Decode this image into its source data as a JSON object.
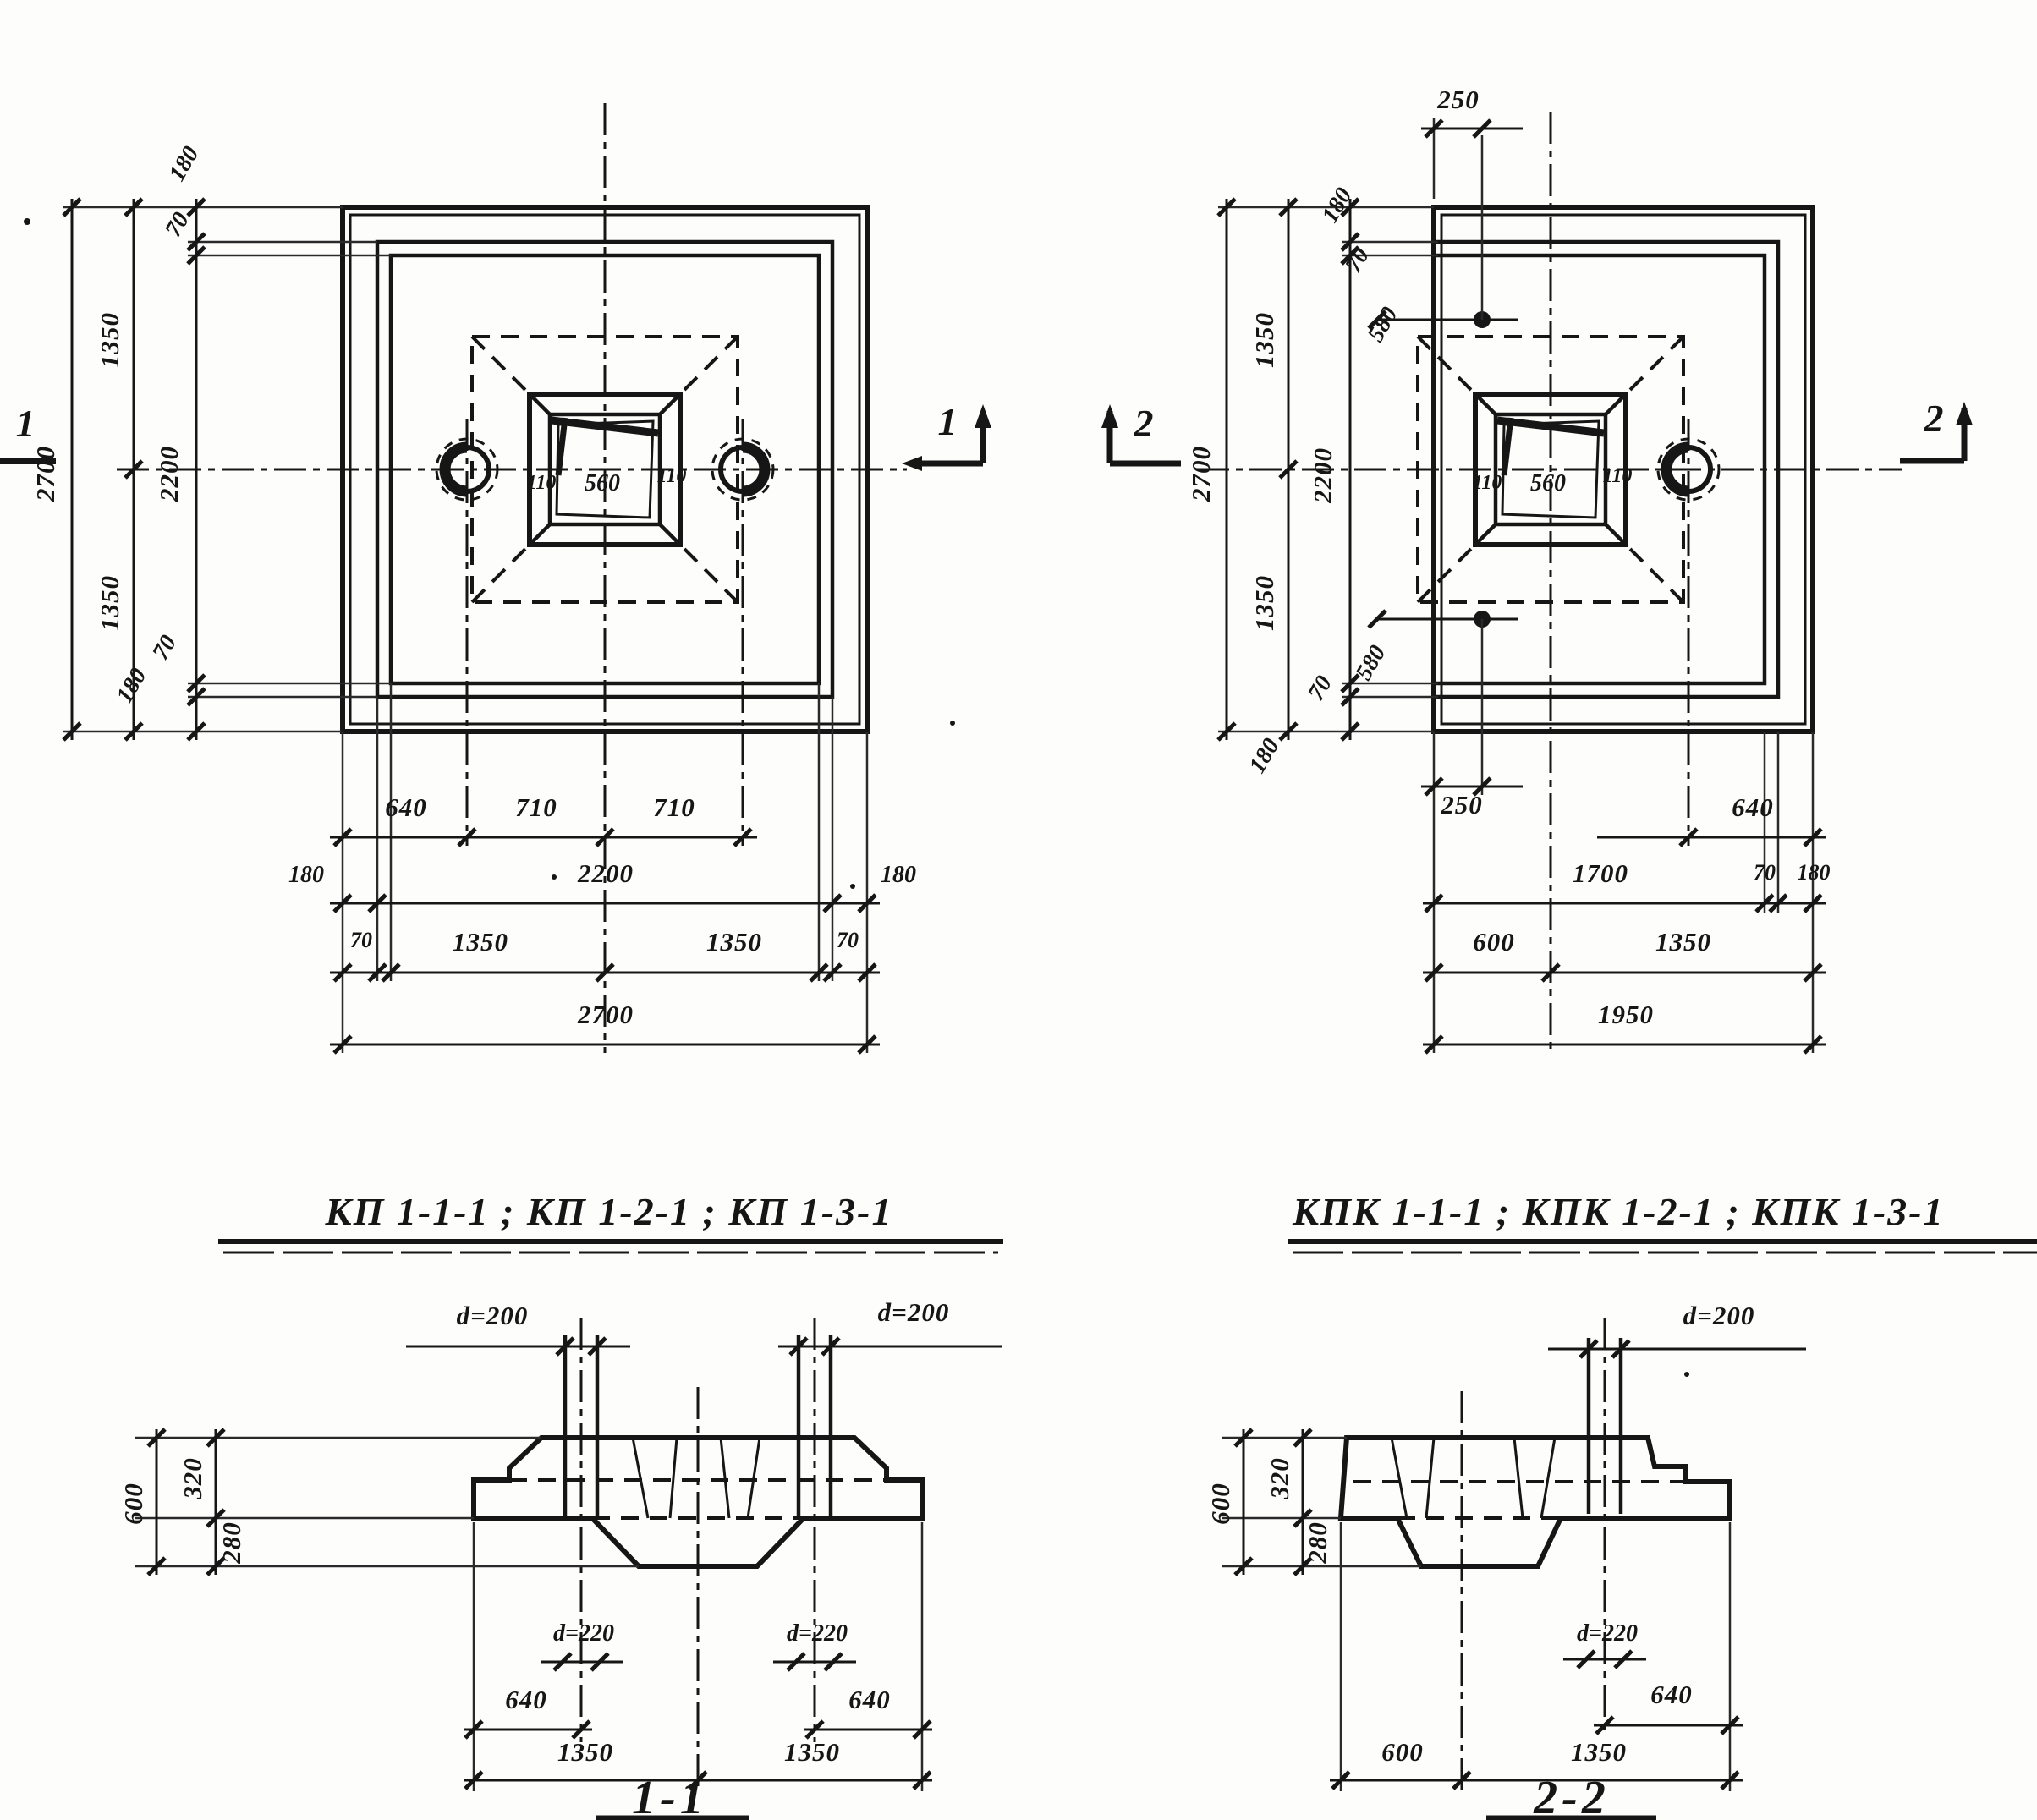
{
  "kp_plan": {
    "title": "КП 1-1-1 ; КП 1-2-1 ; КП 1-3-1",
    "marker": "1",
    "dims": {
      "overall_v": "2700",
      "half_top": "1350",
      "half_bottom": "1350",
      "inner_v": "2200",
      "rim_top_180": "180",
      "rim_top_70": "70",
      "rim_bot_70": "70",
      "rim_bot_180": "180",
      "hole_off": "640",
      "hole_center_l": "710",
      "hole_center_r": "710",
      "wall_l": "180",
      "inner_h": "2200",
      "wall_r": "180",
      "lip_l": "70",
      "half_l": "1350",
      "half_r": "1350",
      "lip_r": "70",
      "overall_h": "2700",
      "socket_wall_l": "110",
      "socket": "560",
      "socket_wall_r": "110"
    }
  },
  "kpk_plan": {
    "title": "КПК 1-1-1 ; КПК 1-2-1 ; КПК 1-3-1",
    "marker": "2",
    "dims": {
      "top_250": "250",
      "bot_250": "250",
      "overall_v": "2700",
      "half_top": "1350",
      "half_bottom": "1350",
      "inner_v": "2200",
      "rim_top_180": "180",
      "rim_top_70": "70",
      "hole_top_580": "580",
      "rim_bot_180": "180",
      "rim_bot_70": "70",
      "hole_bot_580": "580",
      "hole_off": "640",
      "left_1700": "1700",
      "lip_70": "70",
      "wall_180": "180",
      "left_600": "600",
      "right_1350": "1350",
      "overall_h": "1950",
      "socket_wall_l": "110",
      "socket": "560",
      "socket_wall_r": "110"
    }
  },
  "section_1": {
    "title": "1-1",
    "pipe_l": "d=200",
    "pipe_r": "d=200",
    "sleeve_l": "d=220",
    "sleeve_r": "d=220",
    "h": "600",
    "h_top": "320",
    "h_bot": "280",
    "off_l": "640",
    "off_r": "640",
    "half_l": "1350",
    "half_r": "1350"
  },
  "section_2": {
    "title": "2-2",
    "pipe": "d=200",
    "sleeve": "d=220",
    "h": "600",
    "h_top": "320",
    "h_bot": "280",
    "off": "640",
    "left": "600",
    "right": "1350"
  }
}
